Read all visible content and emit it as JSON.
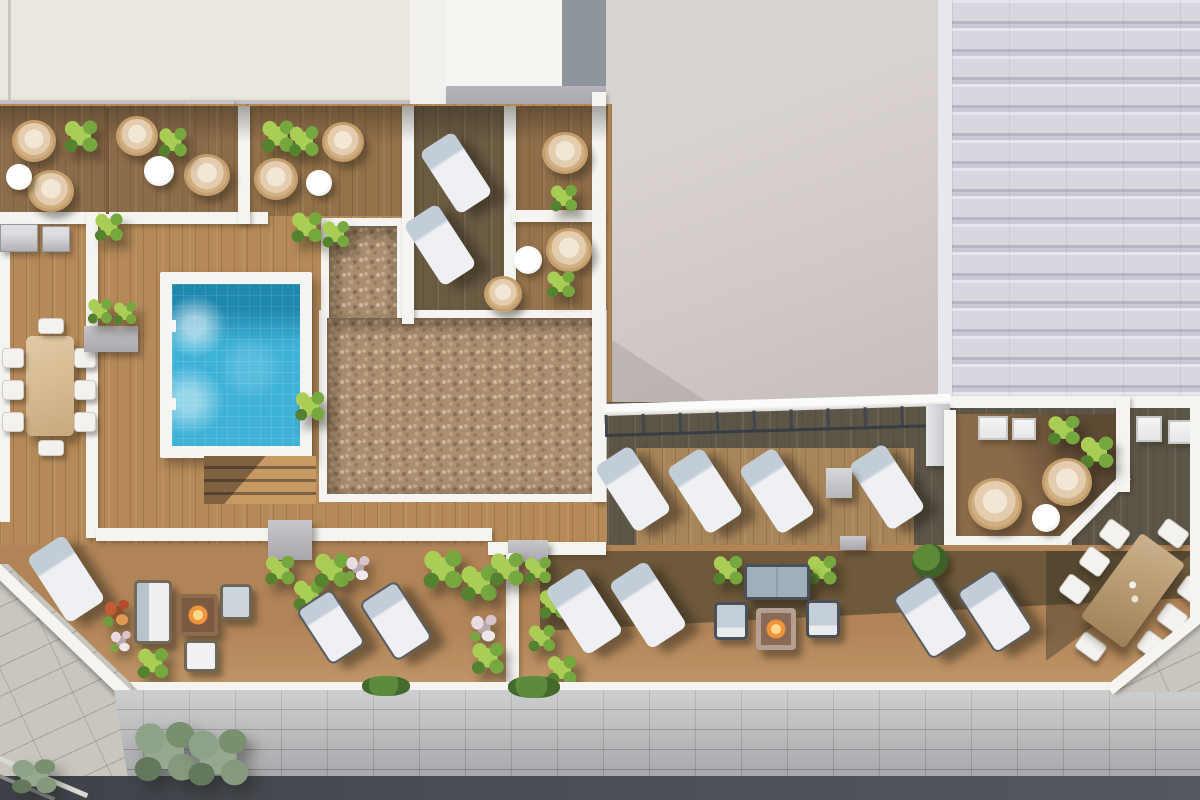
{
  "meta": {
    "title": "Aerial top-down 3D architectural render of a residential rooftop pool terrace",
    "view": "top-down aerial",
    "lighting": "daylight, sun from upper-left casting shadows toward lower-right",
    "visible_text": "none"
  },
  "palette": {
    "wall-white": "#f5f4f1",
    "cream-roof": "#ece8df",
    "beige-wall": "#d2cbc8",
    "tile-roof": "#dcd9e2",
    "gray-block": "#8f959c",
    "facade-gray": "#b9bcbe",
    "sidewalk": "#c9c6bf",
    "road": "#4a4e54",
    "wood-light": "#b58a58",
    "wood-mid": "#8d6c49",
    "wood-dark": "#6b5b43",
    "deck-shadow": "#5c5649",
    "pebble": "#a98e70",
    "pool-water": "#3fb2d8",
    "pool-deep": "#1f88ae",
    "leaf-bright": "#a9cd55",
    "leaf-mid": "#76a83f",
    "leaf-dark": "#55822f",
    "tree-gray": "#8da287",
    "rattan": "#c49e6c",
    "cushion-cream": "#e3cdae",
    "lounge-white": "#eef0f3",
    "lounge-pillow": "#c3cdd7",
    "frame-gray": "#585d63",
    "planter-gray": "#a9a7ad",
    "table-tan": "#cbb28c",
    "flame": "#f0953a",
    "flower-red": "#c35b35",
    "flower-pink": "#e8dce2"
  },
  "scene": {
    "areas": [
      {
        "name": "private-terraces-north",
        "floor": "wood deck",
        "features": [
          "hanging egg chairs",
          "potted palms",
          "round white side tables",
          "white privacy walls",
          "awning shadow"
        ]
      },
      {
        "name": "pool-deck-west",
        "floor": "light wood deck",
        "features": [
          "square tiled swimming pool with white coping",
          "pool ladder",
          "wooden steps",
          "outdoor kitchen counters",
          "8-seat dining table",
          "gray planter with palms"
        ]
      },
      {
        "name": "pebble-garden",
        "floor": "beige pebble gravel",
        "shape": "L-shaped bed with white border"
      },
      {
        "name": "upper-lounge-deck",
        "floor": "dark wood deck",
        "features": [
          "2 white sun loungers"
        ]
      },
      {
        "name": "east-terrace",
        "floor": "wood deck",
        "features": [
          "glass railing with posts",
          "4 white sun loungers",
          "gray side table",
          "chamfered private corner with 2 hanging chairs, palms and round table",
          "skylights"
        ]
      },
      {
        "name": "south-terrace",
        "floor": "wood deck",
        "features": [
          "sun loungers",
          "wicker lounge set with fire table",
          "sofa set with fire table",
          "rotated 8-seat dining table",
          "planter boxes",
          "palms and flowering shrubs",
          "white divider wall"
        ]
      },
      {
        "name": "street-level",
        "features": [
          "stone paver sidewalk",
          "street trees",
          "gray block facade band",
          "asphalt road",
          "curb lines"
        ]
      },
      {
        "name": "neighbor-roofs",
        "features": [
          "cream flat roof",
          "blank beige facade wall",
          "ribbed metal roof"
        ]
      }
    ],
    "object_counts": {
      "swimming_pool": 1,
      "hanging_egg_chairs": 11,
      "sun_loungers": 15,
      "dining_sets_8_seat": 2,
      "sofas": 2,
      "armchairs": 4,
      "fire_pit_tables": 2,
      "round_side_tables": 6,
      "planter_boxes": 4,
      "outdoor_kitchen_units": 2,
      "skylights": 4,
      "plants_and_shrubs": 30,
      "street_trees": 3
    }
  }
}
